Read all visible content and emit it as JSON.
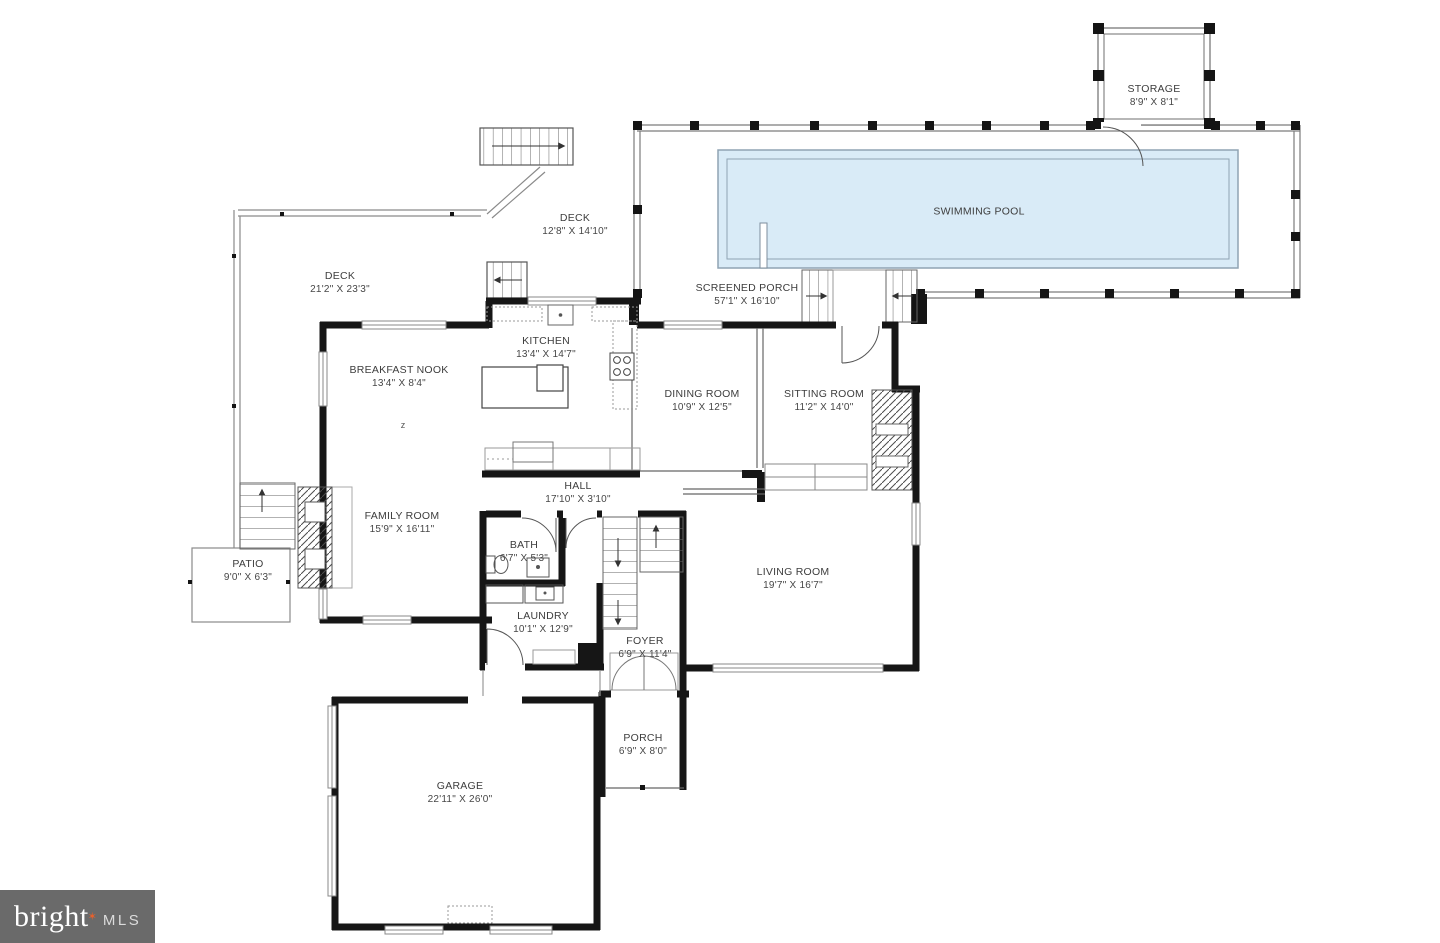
{
  "rooms": [
    {
      "name": "STORAGE",
      "dims": "8'9\" X 8'1\""
    },
    {
      "name": "SWIMMING POOL",
      "dims": ""
    },
    {
      "name": "SCREENED PORCH",
      "dims": "57'1\" X 16'10\""
    },
    {
      "name": "DECK",
      "dims": "12'8\" X 14'10\""
    },
    {
      "name": "DECK",
      "dims": "21'2\" X 23'3\""
    },
    {
      "name": "KITCHEN",
      "dims": "13'4\" X 14'7\""
    },
    {
      "name": "BREAKFAST NOOK",
      "dims": "13'4\" X 8'4\""
    },
    {
      "name": "DINING ROOM",
      "dims": "10'9\" X 12'5\""
    },
    {
      "name": "SITTING ROOM",
      "dims": "11'2\" X 14'0\""
    },
    {
      "name": "HALL",
      "dims": "17'10\" X 3'10\""
    },
    {
      "name": "FAMILY ROOM",
      "dims": "15'9\" X 16'11\""
    },
    {
      "name": "PATIO",
      "dims": "9'0\" X 6'3\""
    },
    {
      "name": "BATH",
      "dims": "6'7\" X 5'3\""
    },
    {
      "name": "LAUNDRY",
      "dims": "10'1\" X 12'9\""
    },
    {
      "name": "FOYER",
      "dims": "6'9\" X 11'4\""
    },
    {
      "name": "LIVING ROOM",
      "dims": "19'7\" X 16'7\""
    },
    {
      "name": "PORCH",
      "dims": "6'9\" X 8'0\""
    },
    {
      "name": "GARAGE",
      "dims": "22'11\" X 26'0\""
    }
  ],
  "misc": {
    "ceiling_mark": "z"
  },
  "logo": {
    "brand": "bright",
    "star": "✶",
    "mls": "MLS"
  },
  "colors": {
    "wall": "#161616",
    "pool_fill": "#d9ebf7",
    "pool_line": "#8fa3b3",
    "thin_line": "#666666",
    "logo_bg": "#6a6a6a",
    "logo_star": "#e8612c"
  }
}
